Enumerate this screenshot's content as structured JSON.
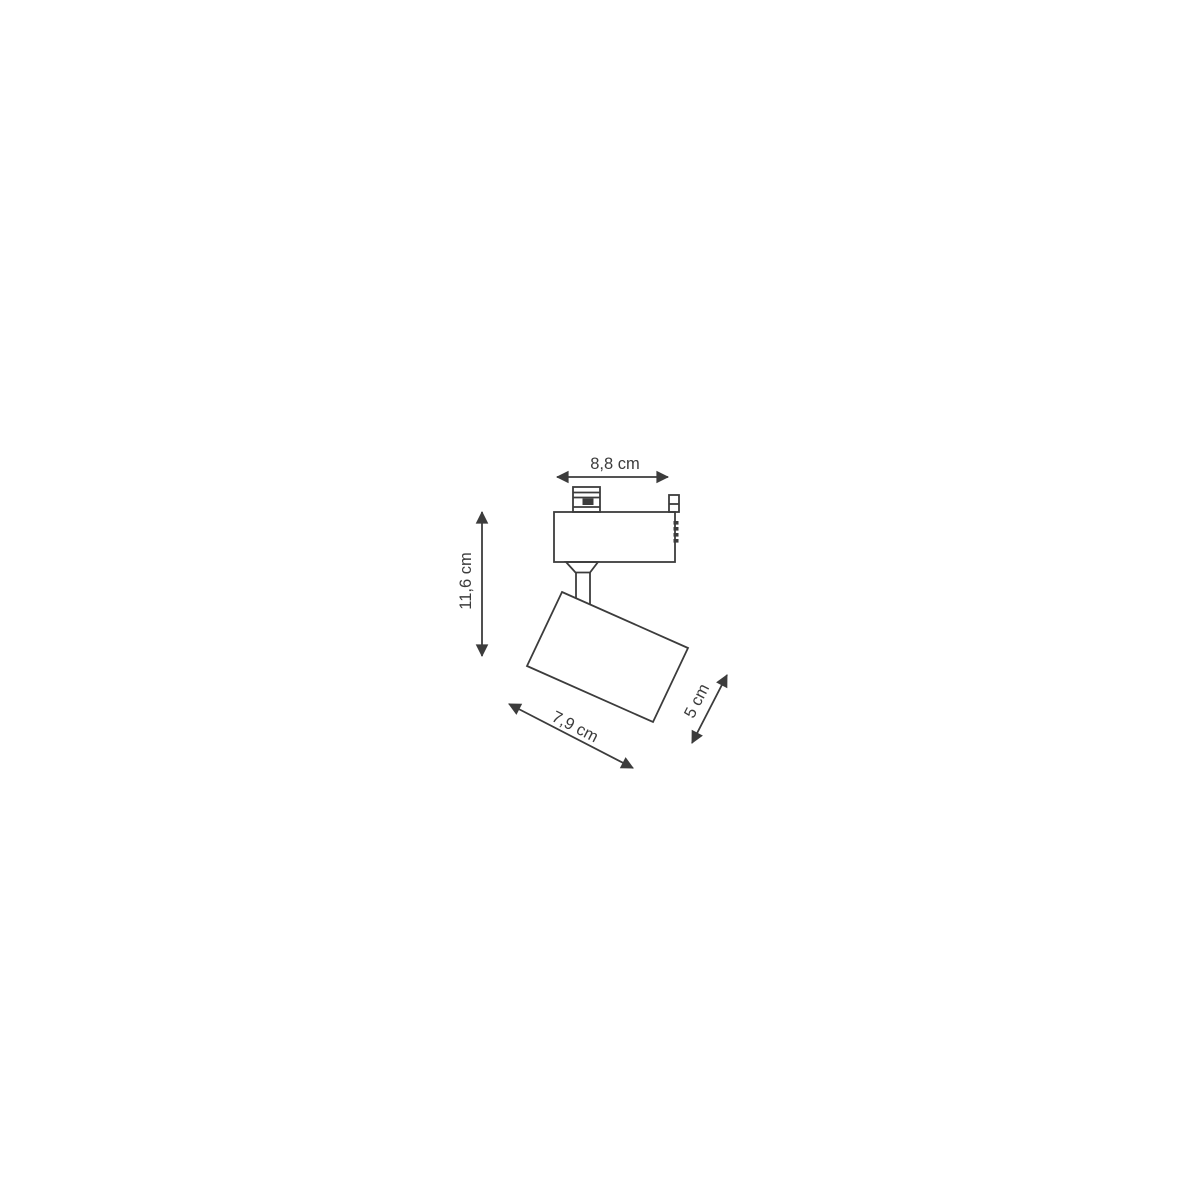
{
  "page": {
    "background_color": "#ffffff"
  },
  "diagram": {
    "kind": "technical-dimension-drawing",
    "subject": "track-light-spotlight-fixture",
    "stroke_color": "#3c3c3c",
    "label_color": "#3c3c3c",
    "units": "cm",
    "dimensions": [
      {
        "id": "adapter-width",
        "label": "8,8 cm",
        "value_cm": 8.8,
        "orientation": "horizontal"
      },
      {
        "id": "total-height",
        "label": "11,6 cm",
        "value_cm": 11.6,
        "orientation": "vertical"
      },
      {
        "id": "head-length",
        "label": "7,9 cm",
        "value_cm": 7.9,
        "orientation": "diagonal"
      },
      {
        "id": "head-diameter",
        "label": "5 cm",
        "value_cm": 5,
        "orientation": "diagonal"
      }
    ]
  }
}
